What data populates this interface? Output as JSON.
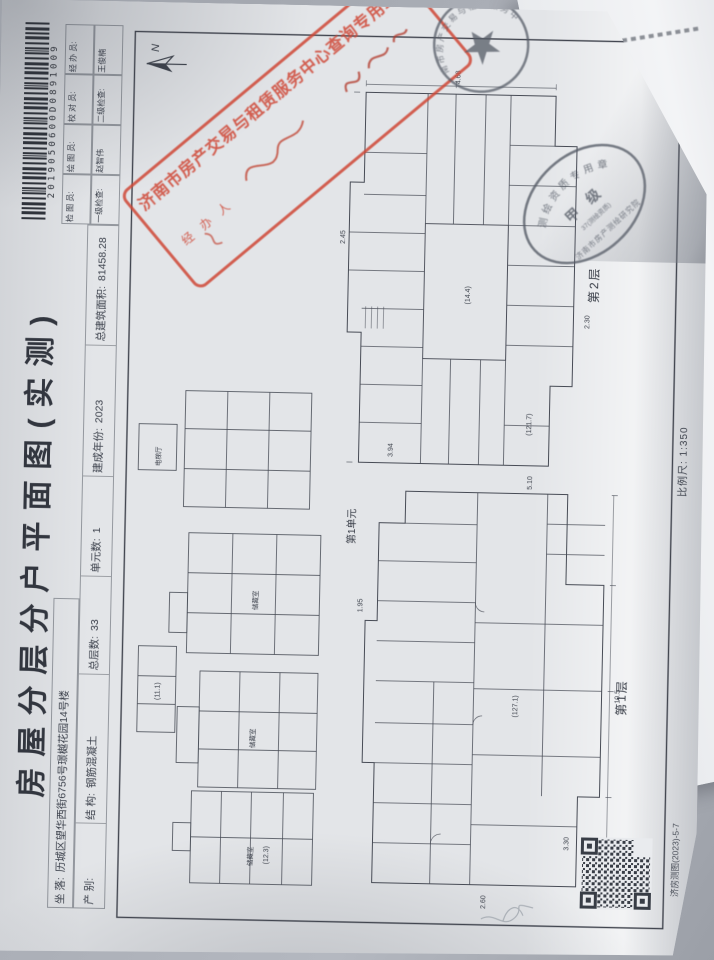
{
  "photo": {
    "background": "#a9adb4"
  },
  "doc": {
    "title": "房屋分层分户平面图(实测)",
    "barcode_number": "2019050600D0891009",
    "north_label": "N",
    "site_row": {
      "label": "坐  落:",
      "value": "历城区望华西街6756号璟樾花园14号楼"
    },
    "fields": [
      {
        "label": "产  别:",
        "value": ""
      },
      {
        "label": "结  构:",
        "value": "钢筋混凝土"
      },
      {
        "label": "总层数:",
        "value": "33"
      },
      {
        "label": "单元数:",
        "value": "1"
      },
      {
        "label": "建成年份:",
        "value": "2023"
      },
      {
        "label": "总建筑面积:",
        "value": "81458.28"
      }
    ],
    "staff": [
      {
        "label": "检 图 员:",
        "value": "一级检查:"
      },
      {
        "label": "绘 图 员:",
        "value": "赵智伟"
      },
      {
        "label": "校 对 员:",
        "value": "二级检查:"
      },
      {
        "label": "经 办 员:",
        "value": "王俊楠"
      }
    ],
    "unit_label": "第1单元",
    "floor1_label": "第1层",
    "floor2_label": "第2层",
    "scale_label": "比例尺: 1:350",
    "footer_code": "济房测图(2023)-5-7",
    "annotations": [
      "储藏室",
      "(121.7)",
      "2.45",
      "4.68",
      "10.5",
      "3.94",
      "(14.4)",
      "2.30",
      "(11.1)",
      "储藏室",
      "1.95",
      "(127.1)",
      "2.60",
      "电梯厅",
      "5.10",
      "(12.3)",
      "3.30",
      "储藏室"
    ]
  },
  "stamps": {
    "red": {
      "line": "济南市房产交易与租赁服务中心查询专用章",
      "operator": "经 办 人",
      "color": "#cf4736"
    },
    "round": {
      "ring": "济南市房产交易与租赁服务中心",
      "color": "#555b66"
    },
    "oval": {
      "top": "测绘资质专用章",
      "grade": "甲 级",
      "cert": "37(测绘资质)",
      "bottom": "济南市房产测绘研究院",
      "color": "#555b66"
    }
  }
}
